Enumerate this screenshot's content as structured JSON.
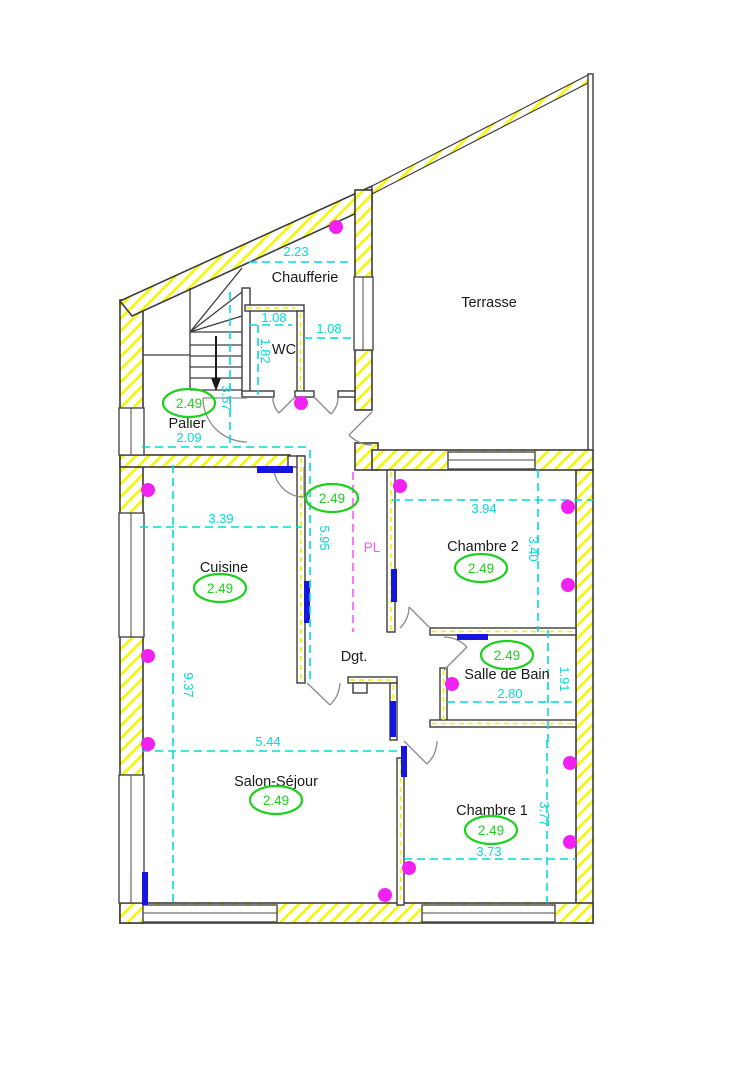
{
  "plan": {
    "rooms": [
      {
        "id": "chaufferie",
        "label": "Chaufferie"
      },
      {
        "id": "terrasse",
        "label": "Terrasse"
      },
      {
        "id": "wc",
        "label": "WC"
      },
      {
        "id": "palier",
        "label": "Palier"
      },
      {
        "id": "cuisine",
        "label": "Cuisine"
      },
      {
        "id": "chambre2",
        "label": "Chambre 2"
      },
      {
        "id": "degagement",
        "label": "Dgt."
      },
      {
        "id": "salle-de-bain",
        "label": "Salle de Bain"
      },
      {
        "id": "salon-sejour",
        "label": "Salon-Séjour"
      },
      {
        "id": "chambre1",
        "label": "Chambre 1"
      }
    ],
    "ceiling_height_badges": [
      {
        "room": "palier",
        "value": "2.49"
      },
      {
        "room": "couloir",
        "value": "2.49"
      },
      {
        "room": "cuisine",
        "value": "2.49"
      },
      {
        "room": "chambre2",
        "value": "2.49"
      },
      {
        "room": "salle-de-bain",
        "value": "2.49"
      },
      {
        "room": "salon-sejour",
        "value": "2.49"
      },
      {
        "room": "chambre1",
        "value": "2.49"
      }
    ],
    "dimensions": [
      {
        "id": "chaufferie-width",
        "value": "2.23",
        "orientation": "horizontal"
      },
      {
        "id": "wc-width",
        "value": "1.08",
        "orientation": "horizontal"
      },
      {
        "id": "chaufferie-passage-width",
        "value": "1.08",
        "orientation": "horizontal"
      },
      {
        "id": "wc-depth",
        "value": "1.82",
        "orientation": "vertical"
      },
      {
        "id": "escalier-height",
        "value": "3.57",
        "orientation": "vertical"
      },
      {
        "id": "palier-width",
        "value": "2.09",
        "orientation": "horizontal"
      },
      {
        "id": "cuisine-width",
        "value": "3.39",
        "orientation": "horizontal"
      },
      {
        "id": "couloir-length",
        "value": "5.95",
        "orientation": "vertical"
      },
      {
        "id": "chambre2-width",
        "value": "3.94",
        "orientation": "horizontal"
      },
      {
        "id": "chambre2-depth",
        "value": "3.40",
        "orientation": "vertical"
      },
      {
        "id": "facade-gauche",
        "value": "9.37",
        "orientation": "vertical"
      },
      {
        "id": "salon-width",
        "value": "5.44",
        "orientation": "horizontal"
      },
      {
        "id": "salle-de-bain-width",
        "value": "2.80",
        "orientation": "horizontal"
      },
      {
        "id": "salle-de-bain-depth",
        "value": "1.91",
        "orientation": "vertical"
      },
      {
        "id": "chambre1-width",
        "value": "3.73",
        "orientation": "horizontal"
      },
      {
        "id": "chambre1-depth",
        "value": "3.77",
        "orientation": "vertical"
      }
    ],
    "closet": {
      "label": "PL"
    },
    "colors": {
      "wall_hatch": "#f6f600",
      "dimension": "#00dcdc",
      "ceiling_height": "#1fd11f",
      "ceiling_light": "#f122f1",
      "closet": "#ff55ff",
      "radiator": "#1515dd",
      "door_swing": "#8a8a8a"
    }
  }
}
